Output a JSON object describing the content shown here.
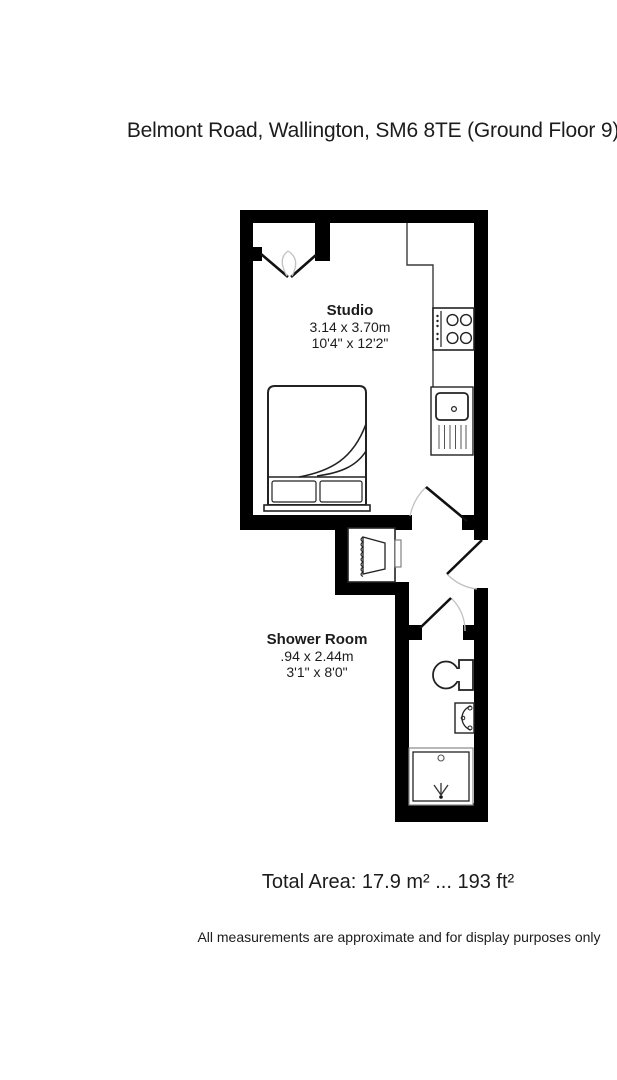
{
  "page": {
    "title": "Belmont Road, Wallington, SM6 8TE (Ground Floor 9)"
  },
  "rooms": {
    "studio": {
      "name": "Studio",
      "size_metric": "3.14 x 3.70m",
      "size_imperial": "10'4\" x 12'2\""
    },
    "shower_room": {
      "name": "Shower Room",
      "size_metric": ".94 x 2.44m",
      "size_imperial": "3'1\" x 8'0\""
    }
  },
  "summary": {
    "total_area": "Total Area: 17.9 m² ... 193 ft²"
  },
  "footer": {
    "disclaimer": "All measurements are approximate and for display purposes only"
  },
  "fixtures": [
    "double-window",
    "bed",
    "wardrobe",
    "hob",
    "kitchen-sink",
    "studio-door",
    "entrance-door",
    "shower-door",
    "toilet",
    "basin",
    "shower-tray"
  ],
  "colors": {
    "background": "#ffffff",
    "wall": "#000000",
    "fixture_line": "#3a3a3a",
    "door_arc": "#c2c2c2",
    "text": "#1c1c1c"
  }
}
